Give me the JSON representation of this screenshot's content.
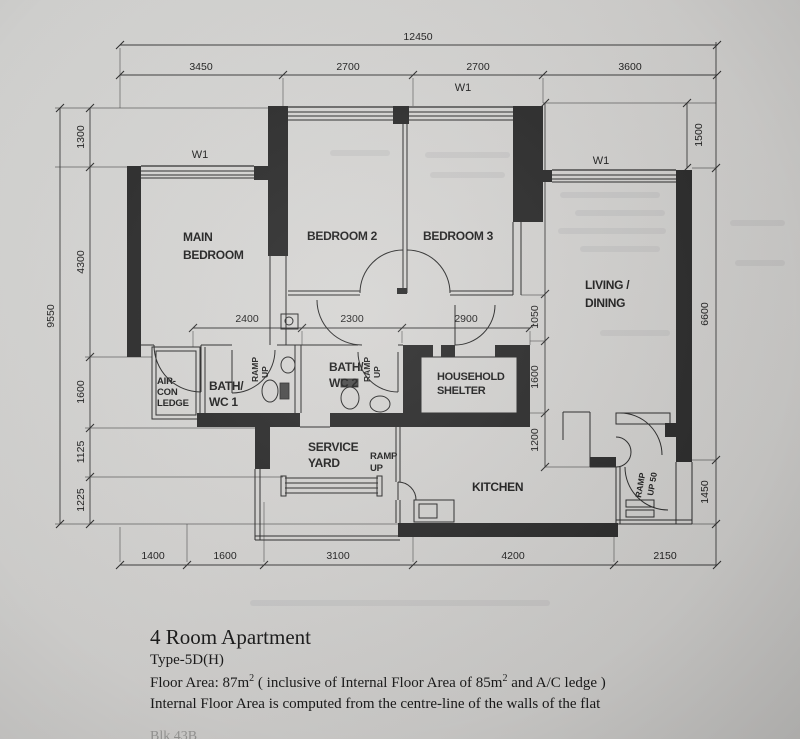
{
  "dims": {
    "top_total": "12450",
    "top": [
      "3450",
      "2700",
      "2700",
      "3600"
    ],
    "left_total": "9550",
    "left": [
      "1300",
      "4300",
      "1600",
      "1125",
      "1225"
    ],
    "right_outer": [
      "1500",
      "6600",
      "1450"
    ],
    "right_inner": [
      "4250",
      "1050",
      "1600",
      "1200"
    ],
    "mid": [
      "2400",
      "2300",
      "2900"
    ],
    "bottom": [
      "1400",
      "1600",
      "3100",
      "4200",
      "2150"
    ]
  },
  "windows": {
    "top": "W1",
    "left": "W1",
    "right": "W1"
  },
  "rooms": {
    "main_bedroom_1": "MAIN",
    "main_bedroom_2": "BEDROOM",
    "bedroom2": "BEDROOM 2",
    "bedroom3": "BEDROOM 3",
    "living_1": "LIVING /",
    "living_2": "DINING",
    "aircon_1": "AIR-",
    "aircon_2": "CON",
    "aircon_3": "LEDGE",
    "bath1_1": "BATH/",
    "bath1_2": "WC 1",
    "bath2_1": "BATH/",
    "bath2_2": "WC 2",
    "shelter_1": "HOUSEHOLD",
    "shelter_2": "SHELTER",
    "service_1": "SERVICE",
    "service_2": "YARD",
    "kitchen": "KITCHEN"
  },
  "ramps": {
    "bath1_1": "RAMP",
    "bath1_2": "UP",
    "bath2_1": "RAMP",
    "bath2_2": "UP",
    "yard_1": "RAMP",
    "yard_2": "UP",
    "entrance_1": "RAMP",
    "entrance_2": "UP 50"
  },
  "title_block": {
    "title": "4 Room Apartment",
    "type_line": "Type-5D(H)",
    "area_pre": "Floor Area: 87m",
    "area_sup1": "2",
    "area_mid": "   ( inclusive of Internal Floor Area of 85m",
    "area_sup2": "2",
    "area_post": " and A/C ledge )",
    "note": "Internal Floor Area is computed from the centre-line of the walls of the flat",
    "footer_partial": "Blk 43B"
  }
}
